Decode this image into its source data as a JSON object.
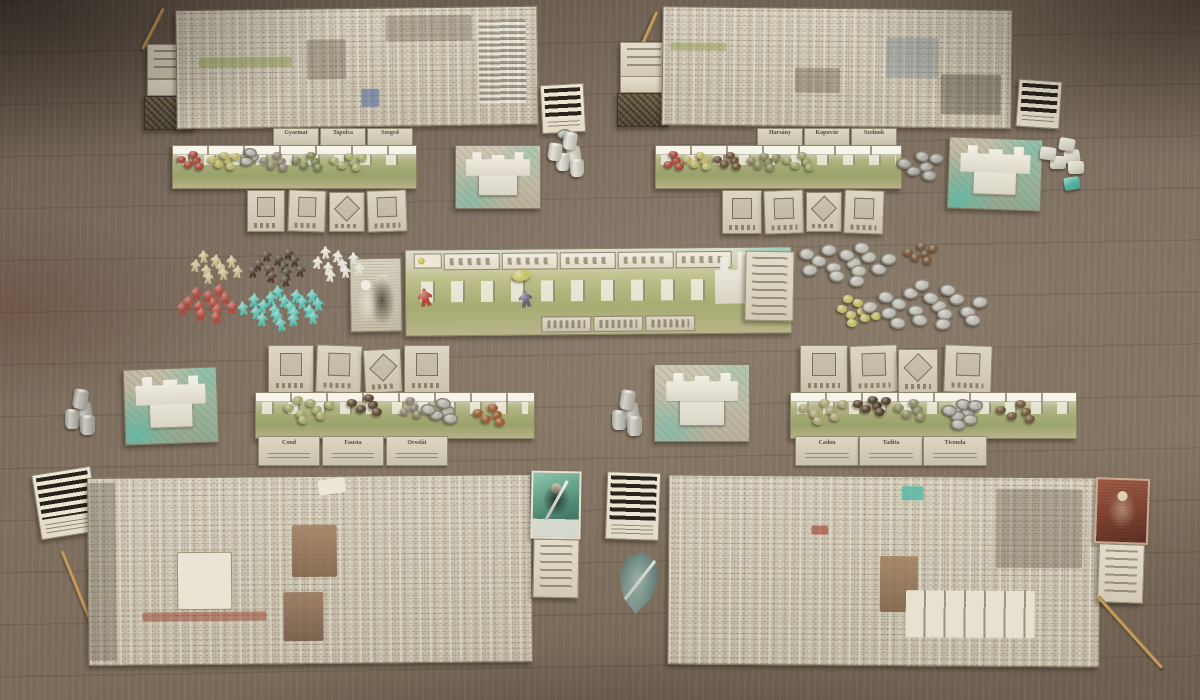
{
  "scene": {
    "type": "overhead photo of a euro board game set up on a wooden table",
    "table_wood_color": "#77685a",
    "accent_teal": "#5fc0ae",
    "parchment": "#d7d0bd"
  },
  "counts": {
    "player_boards": 4,
    "castle_tiles": 4,
    "landscape_strips": 4,
    "pencils": 4,
    "striped_reference_cards": 4,
    "shield_tokens": 1
  },
  "central_board": {
    "action_slots": 5,
    "name_plaques": 3
  },
  "plates": {
    "upper_left": [
      "Gyarmat",
      "Tapolca",
      "Szeged"
    ],
    "upper_right": [
      "Harsány",
      "Kapuvár",
      "Szolnok"
    ],
    "mid_left": [
      "Cond",
      "Fausta",
      "Orsolát"
    ],
    "mid_right": [
      "Cadou",
      "Tadita",
      "Ticonda"
    ]
  },
  "clusters": [
    {
      "name": "meeples-tan",
      "shape": "meeple",
      "color": "#c6bb8d",
      "count": 9,
      "cx": 214,
      "cy": 267,
      "rx": 26,
      "ry": 13,
      "s": 11
    },
    {
      "name": "meeples-darkbrown",
      "shape": "meeple",
      "color": "#4b3e31",
      "count": 12,
      "cx": 277,
      "cy": 266,
      "rx": 30,
      "ry": 15,
      "s": 11
    },
    {
      "name": "meeples-white",
      "shape": "meeple",
      "color": "#e0dbcd",
      "count": 9,
      "cx": 336,
      "cy": 264,
      "rx": 26,
      "ry": 14,
      "s": 11
    },
    {
      "name": "meeples-red",
      "shape": "meeple",
      "color": "#b04a3d",
      "count": 12,
      "cx": 207,
      "cy": 303,
      "rx": 31,
      "ry": 15,
      "s": 12
    },
    {
      "name": "meeples-teal",
      "shape": "meeple",
      "color": "#5fc0b2",
      "count": 20,
      "cx": 283,
      "cy": 307,
      "rx": 43,
      "ry": 17,
      "s": 12
    },
    {
      "name": "coins-silver-upper",
      "shape": "coin",
      "color": "#bcbab1",
      "count": 14,
      "cx": 845,
      "cy": 263,
      "rx": 46,
      "ry": 20,
      "s": 16
    },
    {
      "name": "resources-brown-pile",
      "shape": "blob",
      "color": "#7b5a3d",
      "count": 6,
      "cx": 921,
      "cy": 254,
      "rx": 15,
      "ry": 11,
      "s": 9
    },
    {
      "name": "tokens-yellow-pile",
      "shape": "blob",
      "color": "#c0bd68",
      "count": 9,
      "cx": 857,
      "cy": 311,
      "rx": 21,
      "ry": 15,
      "s": 10
    },
    {
      "name": "coins-silver-lower",
      "shape": "coin",
      "color": "#bcbab1",
      "count": 18,
      "cx": 929,
      "cy": 306,
      "rx": 60,
      "ry": 23,
      "s": 16
    },
    {
      "name": "coin-single",
      "shape": "coin",
      "color": "#b8b6ad",
      "count": 1,
      "cx": 563,
      "cy": 134,
      "rx": 1,
      "ry": 1,
      "s": 14
    },
    {
      "name": "cylinders-white",
      "shape": "cyl",
      "color": "#dcd8cc",
      "count": 5,
      "cx": 569,
      "cy": 155,
      "rx": 15,
      "ry": 20,
      "s": 14
    },
    {
      "name": "dice-white",
      "shape": "cube",
      "color": "#d9d5c8",
      "count": 5,
      "cx": 1066,
      "cy": 156,
      "rx": 19,
      "ry": 17,
      "s": 16
    },
    {
      "name": "die-teal",
      "shape": "cube",
      "color": "#54b5a3",
      "count": 1,
      "cx": 1071,
      "cy": 183,
      "rx": 1,
      "ry": 1,
      "s": 16
    },
    {
      "name": "cylinders-grey-left",
      "shape": "cyl",
      "color": "#b9b6ac",
      "count": 4,
      "cx": 79,
      "cy": 412,
      "rx": 15,
      "ry": 17,
      "s": 15
    },
    {
      "name": "cylinders-grey-right",
      "shape": "cyl",
      "color": "#c6c3b9",
      "count": 4,
      "cx": 626,
      "cy": 413,
      "rx": 15,
      "ry": 17,
      "s": 15
    },
    {
      "name": "strip-ul-red",
      "shape": "blob",
      "color": "#a8493c",
      "count": 5,
      "cx": 193,
      "cy": 161,
      "rx": 12,
      "ry": 9,
      "s": 9
    },
    {
      "name": "strip-ul-yellow",
      "shape": "blob",
      "color": "#b9b468",
      "count": 6,
      "cx": 224,
      "cy": 161,
      "rx": 14,
      "ry": 9,
      "s": 9
    },
    {
      "name": "strip-ul-coins",
      "shape": "coin",
      "color": "#b4b2a9",
      "count": 3,
      "cx": 250,
      "cy": 158,
      "rx": 7,
      "ry": 6,
      "s": 13
    },
    {
      "name": "strip-ul-grey",
      "shape": "blob",
      "color": "#8e8574",
      "count": 5,
      "cx": 277,
      "cy": 162,
      "rx": 13,
      "ry": 9,
      "s": 9
    },
    {
      "name": "strip-ul-green",
      "shape": "blob",
      "color": "#7d8452",
      "count": 5,
      "cx": 311,
      "cy": 162,
      "rx": 15,
      "ry": 9,
      "s": 9
    },
    {
      "name": "strip-ul-lightgreen",
      "shape": "blob",
      "color": "#a6ab70",
      "count": 6,
      "cx": 349,
      "cy": 162,
      "rx": 17,
      "ry": 9,
      "s": 9
    },
    {
      "name": "strip-ur-red",
      "shape": "blob",
      "color": "#a8493c",
      "count": 4,
      "cx": 673,
      "cy": 161,
      "rx": 11,
      "ry": 8,
      "s": 9
    },
    {
      "name": "strip-ur-yellow",
      "shape": "blob",
      "color": "#b9b468",
      "count": 5,
      "cx": 700,
      "cy": 161,
      "rx": 13,
      "ry": 8,
      "s": 9
    },
    {
      "name": "strip-ur-brown",
      "shape": "blob",
      "color": "#6b5238",
      "count": 5,
      "cx": 730,
      "cy": 161,
      "rx": 13,
      "ry": 8,
      "s": 9
    },
    {
      "name": "strip-ur-olive",
      "shape": "blob",
      "color": "#8b8a5c",
      "count": 6,
      "cx": 764,
      "cy": 162,
      "rx": 15,
      "ry": 9,
      "s": 9
    },
    {
      "name": "strip-ur-green",
      "shape": "blob",
      "color": "#9aa167",
      "count": 5,
      "cx": 802,
      "cy": 162,
      "rx": 15,
      "ry": 9,
      "s": 9
    },
    {
      "name": "coins-ur-side",
      "shape": "coin",
      "color": "#aaa89f",
      "count": 6,
      "cx": 921,
      "cy": 166,
      "rx": 19,
      "ry": 15,
      "s": 15
    },
    {
      "name": "strip-ml-green",
      "shape": "blob",
      "color": "#a5a66a",
      "count": 8,
      "cx": 310,
      "cy": 410,
      "rx": 28,
      "ry": 12,
      "s": 10
    },
    {
      "name": "strip-ml-brown",
      "shape": "blob",
      "color": "#5e4b36",
      "count": 5,
      "cx": 368,
      "cy": 405,
      "rx": 17,
      "ry": 10,
      "s": 10
    },
    {
      "name": "strip-ml-grey",
      "shape": "blob",
      "color": "#8d8676",
      "count": 4,
      "cx": 410,
      "cy": 408,
      "rx": 13,
      "ry": 9,
      "s": 9
    },
    {
      "name": "strip-ml-coins",
      "shape": "coin",
      "color": "#b2b0a7",
      "count": 5,
      "cx": 443,
      "cy": 411,
      "rx": 15,
      "ry": 11,
      "s": 15
    },
    {
      "name": "strip-ml-orange",
      "shape": "blob",
      "color": "#9d5c34",
      "count": 5,
      "cx": 492,
      "cy": 415,
      "rx": 15,
      "ry": 10,
      "s": 10
    },
    {
      "name": "strip-mr-tan",
      "shape": "blob",
      "color": "#aba376",
      "count": 7,
      "cx": 824,
      "cy": 410,
      "rx": 25,
      "ry": 12,
      "s": 10
    },
    {
      "name": "strip-mr-brown",
      "shape": "blob",
      "color": "#55422f",
      "count": 6,
      "cx": 872,
      "cy": 406,
      "rx": 17,
      "ry": 10,
      "s": 10
    },
    {
      "name": "strip-mr-olive",
      "shape": "blob",
      "color": "#8d8b61",
      "count": 5,
      "cx": 913,
      "cy": 410,
      "rx": 15,
      "ry": 10,
      "s": 10
    },
    {
      "name": "strip-mr-coins",
      "shape": "coin",
      "color": "#b2b0a7",
      "count": 7,
      "cx": 963,
      "cy": 412,
      "rx": 17,
      "ry": 13,
      "s": 15
    },
    {
      "name": "strip-mr-brown2",
      "shape": "blob",
      "color": "#6f5638",
      "count": 5,
      "cx": 1020,
      "cy": 412,
      "rx": 20,
      "ry": 11,
      "s": 10
    },
    {
      "name": "board-meeple-red",
      "shape": "meeple",
      "color": "#b04a3d",
      "count": 1,
      "cx": 424,
      "cy": 297,
      "rx": 1,
      "ry": 1,
      "s": 16
    },
    {
      "name": "board-disc-yellow",
      "shape": "disc",
      "color": "#c9c26a",
      "count": 1,
      "cx": 521,
      "cy": 276,
      "rx": 1,
      "ry": 1,
      "s": 19
    },
    {
      "name": "board-meeple-purple",
      "shape": "meeple",
      "color": "#6d6375",
      "count": 1,
      "cx": 525,
      "cy": 299,
      "rx": 1,
      "ry": 1,
      "s": 15
    }
  ]
}
